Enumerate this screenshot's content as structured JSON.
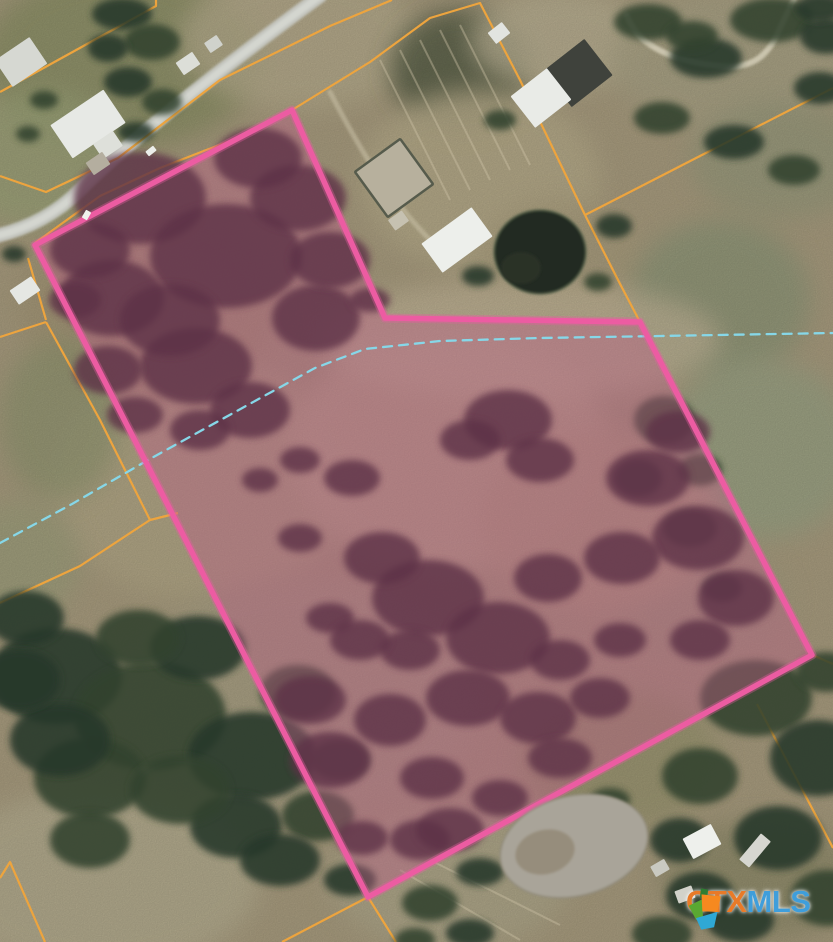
{
  "watermark": {
    "ctx": "CTX",
    "mls": "MLS",
    "ctx_color": "#e87a28",
    "mls_color": "#3f9edb",
    "logo_colors": {
      "green": "#5aa832",
      "dark_green": "#2e7d32",
      "orange": "#f6891f",
      "blue": "#2fa8d5"
    }
  },
  "map": {
    "colors": {
      "ground": "#a79b7e",
      "boundary_pink": "#ec5ca2",
      "boundary_glow": "rgba(236,92,162,0.35)",
      "parcel_overlay_fill": "rgba(187,92,133,0.42)",
      "parcel_line_orange": "#eda43e",
      "stream_blue": "#86d7e8",
      "road_gray": "#c6c8c2",
      "road_center": "#d6d8d2",
      "tree_green": "#33422e",
      "tree_green2": "#27372a",
      "tree_maroon": "#5d3146",
      "pond_dark": "#232b21",
      "pond_gray": "#a9a499"
    },
    "property_boundary": {
      "points": [
        [
          35,
          245
        ],
        [
          292,
          110
        ],
        [
          385,
          318
        ],
        [
          640,
          322
        ],
        [
          812,
          655
        ],
        [
          368,
          897
        ]
      ]
    },
    "stream": {
      "points": [
        [
          0,
          543
        ],
        [
          72,
          504
        ],
        [
          148,
          460
        ],
        [
          235,
          412
        ],
        [
          315,
          368
        ],
        [
          365,
          349
        ],
        [
          440,
          341
        ],
        [
          540,
          338
        ],
        [
          660,
          336
        ],
        [
          833,
          333
        ]
      ],
      "dash": "9 7"
    },
    "parcel_lines": [
      {
        "points": [
          [
            0,
            92
          ],
          [
            156,
            6
          ],
          [
            156,
            0
          ]
        ]
      },
      {
        "points": [
          [
            0,
            176
          ],
          [
            46,
            192
          ],
          [
            118,
            158
          ],
          [
            220,
            80
          ],
          [
            330,
            26
          ],
          [
            392,
            0
          ]
        ]
      },
      {
        "points": [
          [
            292,
            110
          ],
          [
            370,
            62
          ],
          [
            430,
            18
          ],
          [
            480,
            3
          ],
          [
            520,
            80
          ],
          [
            585,
            215
          ]
        ]
      },
      {
        "points": [
          [
            35,
            243
          ],
          [
            100,
            196
          ],
          [
            160,
            168
          ],
          [
            250,
            133
          ],
          [
            290,
            113
          ]
        ]
      },
      {
        "points": [
          [
            28,
            258
          ],
          [
            46,
            320
          ]
        ]
      },
      {
        "points": [
          [
            0,
            337
          ],
          [
            46,
            322
          ]
        ]
      },
      {
        "points": [
          [
            46,
            322
          ],
          [
            100,
            420
          ],
          [
            150,
            520
          ]
        ]
      },
      {
        "points": [
          [
            150,
            520
          ],
          [
            178,
            513
          ]
        ]
      },
      {
        "points": [
          [
            150,
            520
          ],
          [
            80,
            566
          ],
          [
            0,
            603
          ]
        ]
      },
      {
        "points": [
          [
            585,
            215
          ],
          [
            700,
            156
          ],
          [
            833,
            88
          ]
        ]
      },
      {
        "points": [
          [
            585,
            215
          ],
          [
            618,
            280
          ],
          [
            640,
            322
          ]
        ]
      },
      {
        "points": [
          [
            0,
            878
          ],
          [
            10,
            862
          ],
          [
            45,
            942
          ]
        ]
      },
      {
        "points": [
          [
            368,
            897
          ],
          [
            282,
            942
          ]
        ]
      },
      {
        "points": [
          [
            368,
            897
          ],
          [
            396,
            942
          ]
        ]
      },
      {
        "points": [
          [
            812,
            655
          ],
          [
            833,
            664
          ]
        ]
      },
      {
        "points": [
          [
            757,
            704
          ],
          [
            795,
            776
          ],
          [
            833,
            848
          ]
        ]
      }
    ],
    "roads": [
      {
        "d": "M 320,-4 C 260,40 140,130 80,190 C 58,212 30,228 -4,236",
        "color": "#c6c8c2",
        "width": 14,
        "opacity": 0.95
      },
      {
        "d": "M 320,-4 C 260,40 140,130 80,190 C 58,212 30,228 -4,236",
        "color": "#d6d8d2",
        "width": 7,
        "opacity": 0.9
      },
      {
        "d": "M 627,16 C 640,50 680,62 720,66 C 756,70 770,52 780,28 C 786,16 790,6 794,0",
        "color": "#d8d2bc",
        "width": 6,
        "opacity": 0.8
      },
      {
        "d": "M 330,92 C 360,150 390,200 432,242",
        "color": "#cbc2a8",
        "width": 5,
        "opacity": 0.55
      }
    ],
    "furrows": [
      {
        "x1": 380,
        "y1": 60,
        "x2": 450,
        "y2": 200
      },
      {
        "x1": 400,
        "y1": 50,
        "x2": 470,
        "y2": 190
      },
      {
        "x1": 420,
        "y1": 40,
        "x2": 490,
        "y2": 180
      },
      {
        "x1": 440,
        "y1": 30,
        "x2": 510,
        "y2": 170
      },
      {
        "x1": 460,
        "y1": 25,
        "x2": 530,
        "y2": 165
      },
      {
        "x1": 400,
        "y1": 870,
        "x2": 520,
        "y2": 940
      },
      {
        "x1": 430,
        "y1": 860,
        "x2": 560,
        "y2": 925
      }
    ],
    "terrain_patches": [
      [
        120,
        60,
        140,
        90,
        "#8d9068",
        0.9
      ],
      [
        40,
        160,
        90,
        70,
        "#9aa177",
        0.8
      ],
      [
        300,
        40,
        120,
        70,
        "#b5ab8c",
        0.8
      ],
      [
        460,
        70,
        70,
        60,
        "#4e5740",
        0.75
      ],
      [
        560,
        40,
        90,
        50,
        "#b9b093",
        0.8
      ],
      [
        730,
        60,
        120,
        70,
        "#a8a184",
        0.85
      ],
      [
        780,
        160,
        90,
        60,
        "#98997b",
        0.8
      ],
      [
        480,
        180,
        120,
        90,
        "#b4a988",
        0.9
      ],
      [
        560,
        260,
        80,
        60,
        "#a89c7d",
        0.8
      ],
      [
        720,
        300,
        90,
        80,
        "#8f9678",
        0.85
      ],
      [
        760,
        450,
        100,
        90,
        "#9aa183",
        0.85
      ],
      [
        700,
        600,
        90,
        60,
        "#a39b7e",
        0.8
      ],
      [
        200,
        480,
        150,
        120,
        "#b0a585",
        0.9
      ],
      [
        450,
        450,
        160,
        120,
        "#b9aa8d",
        0.9
      ],
      [
        600,
        520,
        120,
        90,
        "#b2a183",
        0.85
      ],
      [
        150,
        300,
        130,
        100,
        "#a39576",
        0.85
      ],
      [
        300,
        700,
        180,
        120,
        "#a89f83",
        0.9
      ],
      [
        100,
        880,
        160,
        90,
        "#b3ab8e",
        0.9
      ],
      [
        450,
        880,
        120,
        70,
        "#ada689",
        0.85
      ],
      [
        620,
        760,
        100,
        70,
        "#99946f",
        0.8
      ],
      [
        760,
        880,
        100,
        60,
        "#8e8a6a",
        0.8
      ],
      [
        520,
        340,
        200,
        60,
        "#c2b598",
        0.7
      ],
      [
        60,
        420,
        60,
        80,
        "#8f946f",
        0.7
      ],
      [
        20,
        560,
        60,
        60,
        "#9c9f7c",
        0.7
      ]
    ],
    "trees_green": [
      [
        122,
        14,
        30,
        16
      ],
      [
        152,
        42,
        28,
        18
      ],
      [
        128,
        82,
        24,
        15
      ],
      [
        162,
        102,
        20,
        13
      ],
      [
        108,
        48,
        20,
        14
      ],
      [
        44,
        100,
        14,
        9
      ],
      [
        136,
        132,
        18,
        10
      ],
      [
        28,
        134,
        12,
        8
      ],
      [
        14,
        254,
        12,
        8
      ],
      [
        648,
        22,
        34,
        18
      ],
      [
        706,
        58,
        36,
        20
      ],
      [
        772,
        20,
        42,
        22
      ],
      [
        820,
        88,
        26,
        16
      ],
      [
        662,
        118,
        28,
        16
      ],
      [
        734,
        142,
        30,
        17
      ],
      [
        794,
        170,
        26,
        15
      ],
      [
        826,
        36,
        26,
        18
      ],
      [
        692,
        36,
        26,
        15
      ],
      [
        820,
        8,
        24,
        14
      ],
      [
        664,
        420,
        30,
        24
      ],
      [
        638,
        478,
        24,
        19
      ],
      [
        690,
        528,
        27,
        19
      ],
      [
        722,
        588,
        20,
        14
      ],
      [
        700,
        470,
        22,
        16
      ],
      [
        614,
        226,
        18,
        12
      ],
      [
        598,
        282,
        14,
        9
      ],
      [
        478,
        276,
        16,
        10
      ],
      [
        500,
        120,
        16,
        10
      ],
      [
        56,
        676,
        66,
        48
      ],
      [
        150,
        716,
        76,
        54
      ],
      [
        252,
        756,
        64,
        44
      ],
      [
        90,
        778,
        56,
        40
      ],
      [
        198,
        648,
        48,
        32
      ],
      [
        298,
        692,
        38,
        27
      ],
      [
        26,
        618,
        38,
        27
      ],
      [
        138,
        638,
        42,
        28
      ],
      [
        236,
        826,
        46,
        32
      ],
      [
        318,
        816,
        36,
        25
      ],
      [
        60,
        740,
        50,
        36
      ],
      [
        180,
        790,
        50,
        34
      ],
      [
        280,
        860,
        40,
        26
      ],
      [
        90,
        840,
        40,
        28
      ],
      [
        20,
        680,
        40,
        30
      ],
      [
        340,
        760,
        30,
        20
      ],
      [
        350,
        880,
        26,
        16
      ],
      [
        756,
        698,
        56,
        38
      ],
      [
        818,
        758,
        48,
        38
      ],
      [
        700,
        776,
        38,
        28
      ],
      [
        778,
        838,
        44,
        32
      ],
      [
        828,
        898,
        38,
        28
      ],
      [
        700,
        896,
        34,
        24
      ],
      [
        662,
        934,
        30,
        18
      ],
      [
        740,
        920,
        34,
        22
      ],
      [
        826,
        672,
        30,
        20
      ],
      [
        680,
        840,
        30,
        22
      ],
      [
        430,
        903,
        28,
        18
      ],
      [
        470,
        933,
        24,
        14
      ],
      [
        415,
        940,
        20,
        12
      ],
      [
        565,
        823,
        26,
        16
      ],
      [
        610,
        800,
        20,
        12
      ],
      [
        480,
        872,
        24,
        14
      ]
    ],
    "trees_maroon": [
      [
        140,
        198,
        66,
        46
      ],
      [
        226,
        256,
        76,
        52
      ],
      [
        112,
        298,
        52,
        38
      ],
      [
        196,
        366,
        56,
        38
      ],
      [
        298,
        198,
        48,
        33
      ],
      [
        316,
        318,
        44,
        33
      ],
      [
        108,
        370,
        34,
        24
      ],
      [
        258,
        158,
        44,
        30
      ],
      [
        170,
        320,
        50,
        36
      ],
      [
        250,
        410,
        40,
        28
      ],
      [
        330,
        260,
        40,
        28
      ],
      [
        90,
        250,
        40,
        28
      ],
      [
        75,
        300,
        26,
        18
      ],
      [
        200,
        430,
        30,
        20
      ],
      [
        135,
        415,
        28,
        18
      ],
      [
        370,
        300,
        20,
        12
      ],
      [
        352,
        478,
        28,
        18
      ],
      [
        428,
        598,
        56,
        38
      ],
      [
        498,
        638,
        52,
        36
      ],
      [
        382,
        558,
        38,
        26
      ],
      [
        548,
        578,
        34,
        24
      ],
      [
        468,
        698,
        42,
        28
      ],
      [
        538,
        718,
        38,
        26
      ],
      [
        648,
        478,
        42,
        28
      ],
      [
        698,
        538,
        46,
        32
      ],
      [
        622,
        558,
        38,
        26
      ],
      [
        736,
        598,
        38,
        28
      ],
      [
        678,
        432,
        32,
        21
      ],
      [
        300,
        538,
        22,
        14
      ],
      [
        330,
        618,
        24,
        15
      ],
      [
        600,
        698,
        30,
        20
      ],
      [
        432,
        778,
        32,
        21
      ],
      [
        362,
        838,
        26,
        17
      ],
      [
        500,
        798,
        28,
        18
      ],
      [
        560,
        758,
        32,
        20
      ],
      [
        410,
        650,
        30,
        20
      ],
      [
        560,
        660,
        30,
        20
      ],
      [
        300,
        460,
        20,
        13
      ],
      [
        620,
        640,
        26,
        17
      ],
      [
        700,
        640,
        30,
        20
      ],
      [
        260,
        480,
        18,
        12
      ],
      [
        508,
        420,
        44,
        30
      ],
      [
        470,
        440,
        30,
        20
      ],
      [
        540,
        460,
        34,
        22
      ],
      [
        330,
        760,
        40,
        28
      ],
      [
        310,
        700,
        36,
        24
      ],
      [
        360,
        640,
        30,
        20
      ],
      [
        390,
        720,
        36,
        26
      ],
      [
        420,
        840,
        30,
        20
      ],
      [
        450,
        830,
        34,
        22
      ]
    ],
    "buildings": [
      {
        "x": 0,
        "y": 46,
        "w": 42,
        "h": 32,
        "rot": -34,
        "fill": "#d6d8d2"
      },
      {
        "x": 56,
        "y": 104,
        "w": 64,
        "h": 40,
        "rot": -34,
        "fill": "#e7e9e5"
      },
      {
        "x": 96,
        "y": 136,
        "w": 24,
        "h": 18,
        "rot": -34,
        "fill": "#dee0da"
      },
      {
        "x": 88,
        "y": 156,
        "w": 20,
        "h": 15,
        "rot": -34,
        "fill": "#b4ae9f"
      },
      {
        "x": 178,
        "y": 56,
        "w": 20,
        "h": 15,
        "rot": -34,
        "fill": "#dcded8"
      },
      {
        "x": 206,
        "y": 38,
        "w": 15,
        "h": 12,
        "rot": -34,
        "fill": "#d0d2cc"
      },
      {
        "x": 552,
        "y": 50,
        "w": 52,
        "h": 46,
        "rot": -38,
        "fill": "#3f423c"
      },
      {
        "x": 518,
        "y": 78,
        "w": 46,
        "h": 40,
        "rot": -38,
        "fill": "#e9ebe7"
      },
      {
        "x": 490,
        "y": 26,
        "w": 18,
        "h": 14,
        "rot": -38,
        "fill": "#e2e4e0"
      },
      {
        "x": 426,
        "y": 222,
        "w": 62,
        "h": 36,
        "rot": -36,
        "fill": "#edefeb"
      },
      {
        "x": 390,
        "y": 214,
        "w": 17,
        "h": 13,
        "rot": -36,
        "fill": "#c6c1b1"
      },
      {
        "x": 366,
        "y": 150,
        "w": 56,
        "h": 56,
        "rot": -36,
        "fill": "#b7b09d",
        "stroke": "#565b4c",
        "sw": 2.5
      },
      {
        "x": 686,
        "y": 830,
        "w": 32,
        "h": 23,
        "rot": -28,
        "fill": "#eef0ec"
      },
      {
        "x": 738,
        "y": 844,
        "w": 34,
        "h": 13,
        "rot": -50,
        "fill": "#d6d6d0"
      },
      {
        "x": 652,
        "y": 862,
        "w": 16,
        "h": 12,
        "rot": -30,
        "fill": "#c9c9c1"
      },
      {
        "x": 676,
        "y": 888,
        "w": 18,
        "h": 13,
        "rot": -20,
        "fill": "#d2d2ca"
      },
      {
        "x": 12,
        "y": 282,
        "w": 26,
        "h": 17,
        "rot": -34,
        "fill": "#e5e7e3"
      }
    ],
    "cars": [
      {
        "x": 146,
        "y": 148,
        "w": 10,
        "h": 6,
        "rot": -38,
        "fill": "#eceeea"
      },
      {
        "x": 82,
        "y": 212,
        "w": 9,
        "h": 6,
        "rot": -60,
        "fill": "#f0f2ee"
      }
    ],
    "ponds": [
      {
        "cx": 540,
        "cy": 252,
        "rx": 46,
        "ry": 42,
        "rot": 0,
        "fill": "#232b21",
        "stroke": "#5a654e"
      },
      {
        "cx": 521,
        "cy": 268,
        "rx": 20,
        "ry": 16,
        "rot": 0,
        "fill": "#2a3326",
        "stroke": "none"
      },
      {
        "cx": 574,
        "cy": 846,
        "rx": 75,
        "ry": 50,
        "rot": -14,
        "fill": "#a9a499",
        "stroke": "#8e8878"
      },
      {
        "cx": 545,
        "cy": 852,
        "rx": 30,
        "ry": 22,
        "rot": -14,
        "fill": "#968d7c",
        "stroke": "none"
      }
    ]
  }
}
